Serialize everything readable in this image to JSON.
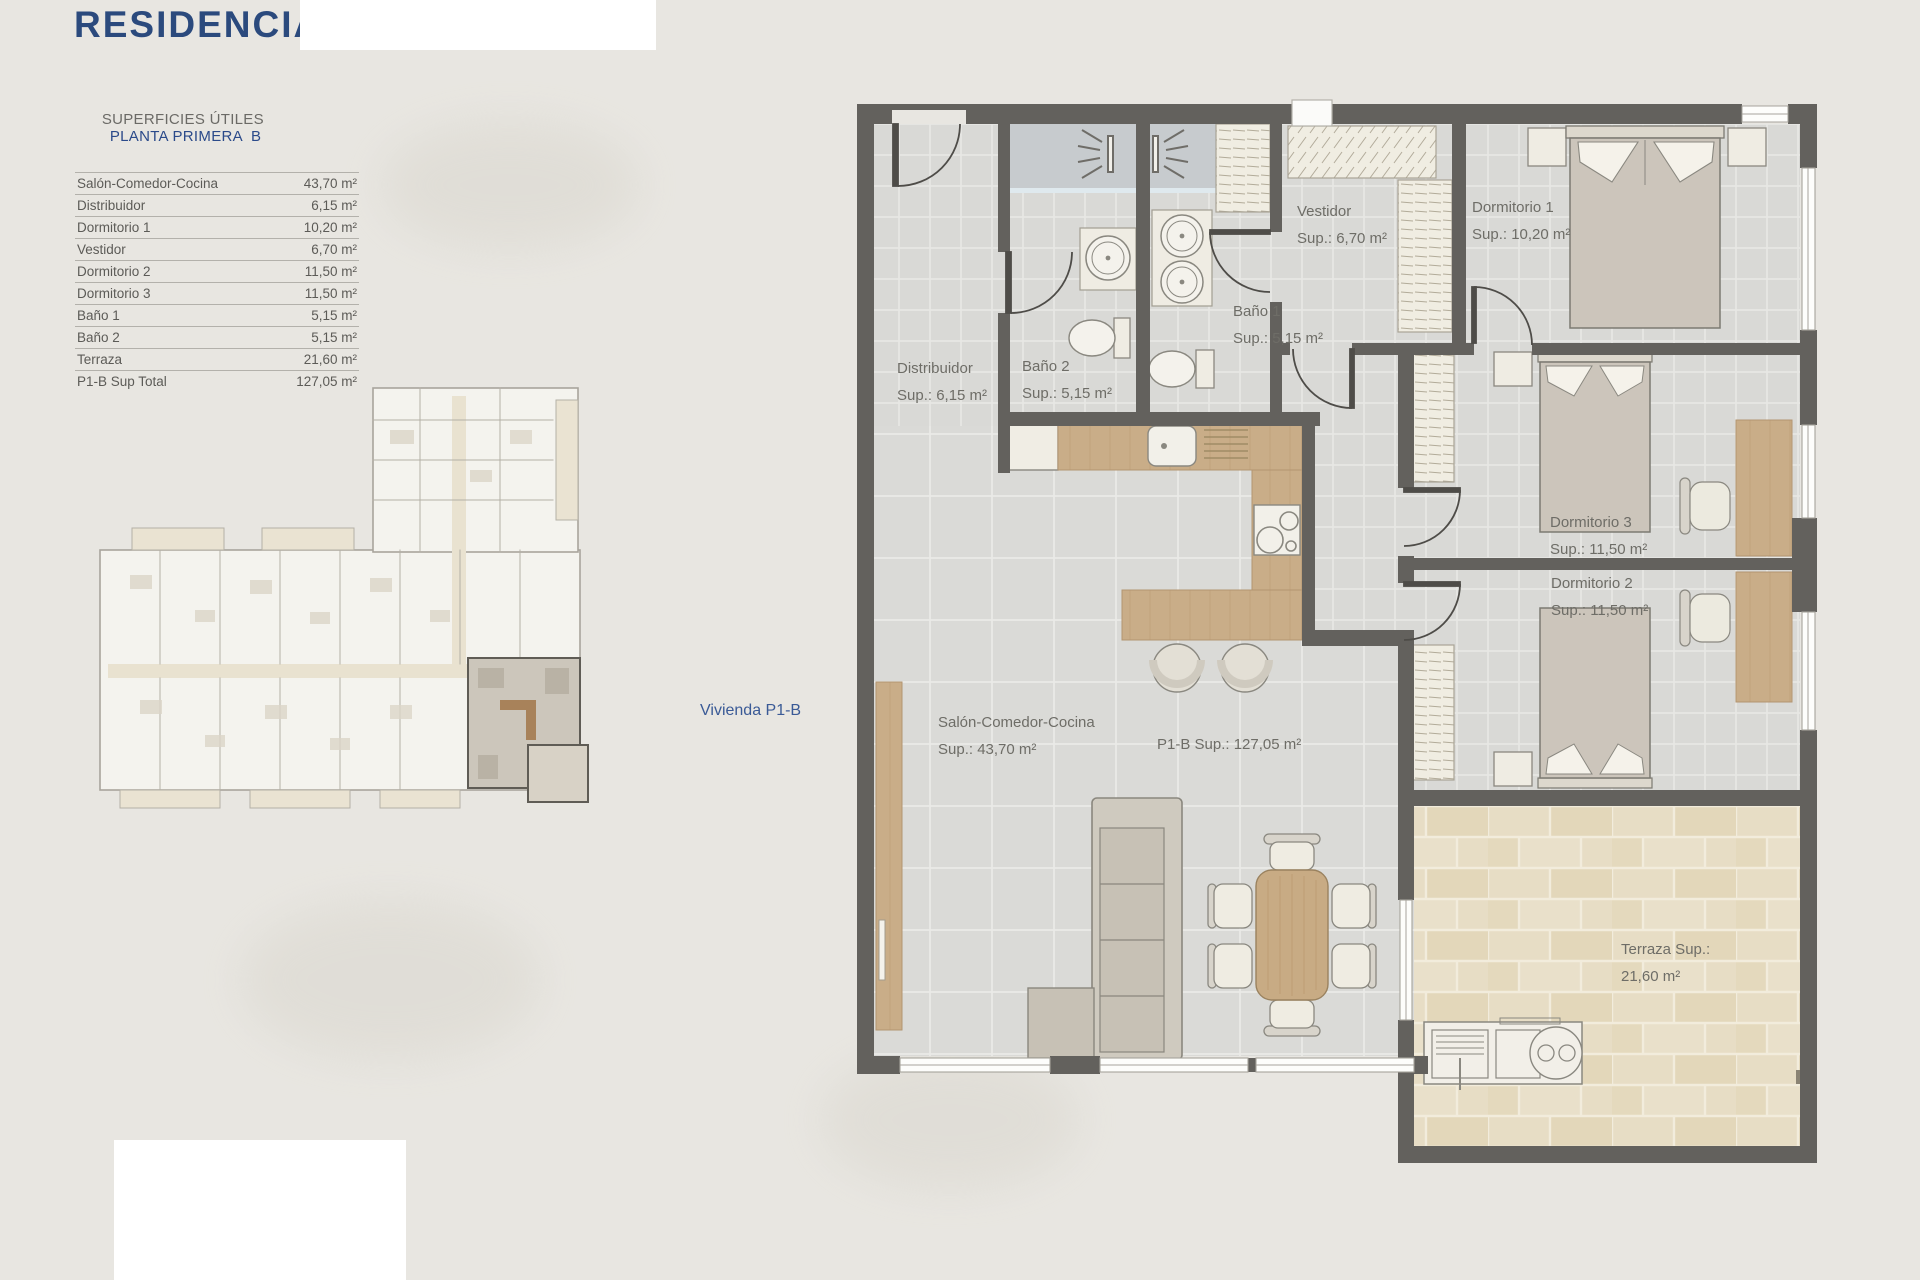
{
  "page": {
    "title": "RESIDENCIAL",
    "accent_blue": "#2b4a7d",
    "wall_color": "#63615d",
    "background": "#e8e6e1"
  },
  "surfaces_table": {
    "header_left": "SUPERFICIES ÚTILES",
    "header_right": "PLANTA PRIMERA  B",
    "rows": [
      {
        "label": "Salón-Comedor-Cocina",
        "value": "43,70 m²"
      },
      {
        "label": "Distribuidor",
        "value": "6,15 m²"
      },
      {
        "label": "Dormitorio 1",
        "value": "10,20 m²"
      },
      {
        "label": "Vestidor",
        "value": "6,70 m²"
      },
      {
        "label": "Dormitorio 2",
        "value": "11,50 m²"
      },
      {
        "label": "Dormitorio 3",
        "value": "11,50 m²"
      },
      {
        "label": "Baño 1",
        "value": "5,15 m²"
      },
      {
        "label": "Baño 2",
        "value": "5,15 m²"
      },
      {
        "label": "Terraza",
        "value": "21,60 m²"
      },
      {
        "label": "P1-B Sup Total",
        "value": "127,05 m²"
      }
    ]
  },
  "overview_plan": {
    "callout": "Vivienda P1-B"
  },
  "floor_plan": {
    "rooms": [
      {
        "id": "distribuidor",
        "name": "Distribuidor",
        "sup": "Sup.: 6,15 m²"
      },
      {
        "id": "bano2",
        "name": "Baño 2",
        "sup": "Sup.: 5,15 m²"
      },
      {
        "id": "bano1",
        "name": "Baño 1",
        "sup": "Sup.: 5,15  m²"
      },
      {
        "id": "vestidor",
        "name": "Vestidor",
        "sup": "Sup.: 6,70 m²"
      },
      {
        "id": "dormitorio1",
        "name": "Dormitorio 1",
        "sup": "Sup.: 10,20 m²"
      },
      {
        "id": "dormitorio3",
        "name": "Dormitorio 3",
        "sup": "Sup.: 11,50 m²"
      },
      {
        "id": "dormitorio2",
        "name": "Dormitorio 2",
        "sup": "Sup.: 11,50 m²"
      },
      {
        "id": "salon",
        "name": "Salón-Comedor-Cocina",
        "sup": "Sup.: 43,70 m²"
      },
      {
        "id": "total",
        "name": "P1-B Sup.: 127,05 m²",
        "sup": ""
      },
      {
        "id": "terraza",
        "name": "Terraza Sup.:",
        "sup": "21,60 m²"
      }
    ]
  }
}
